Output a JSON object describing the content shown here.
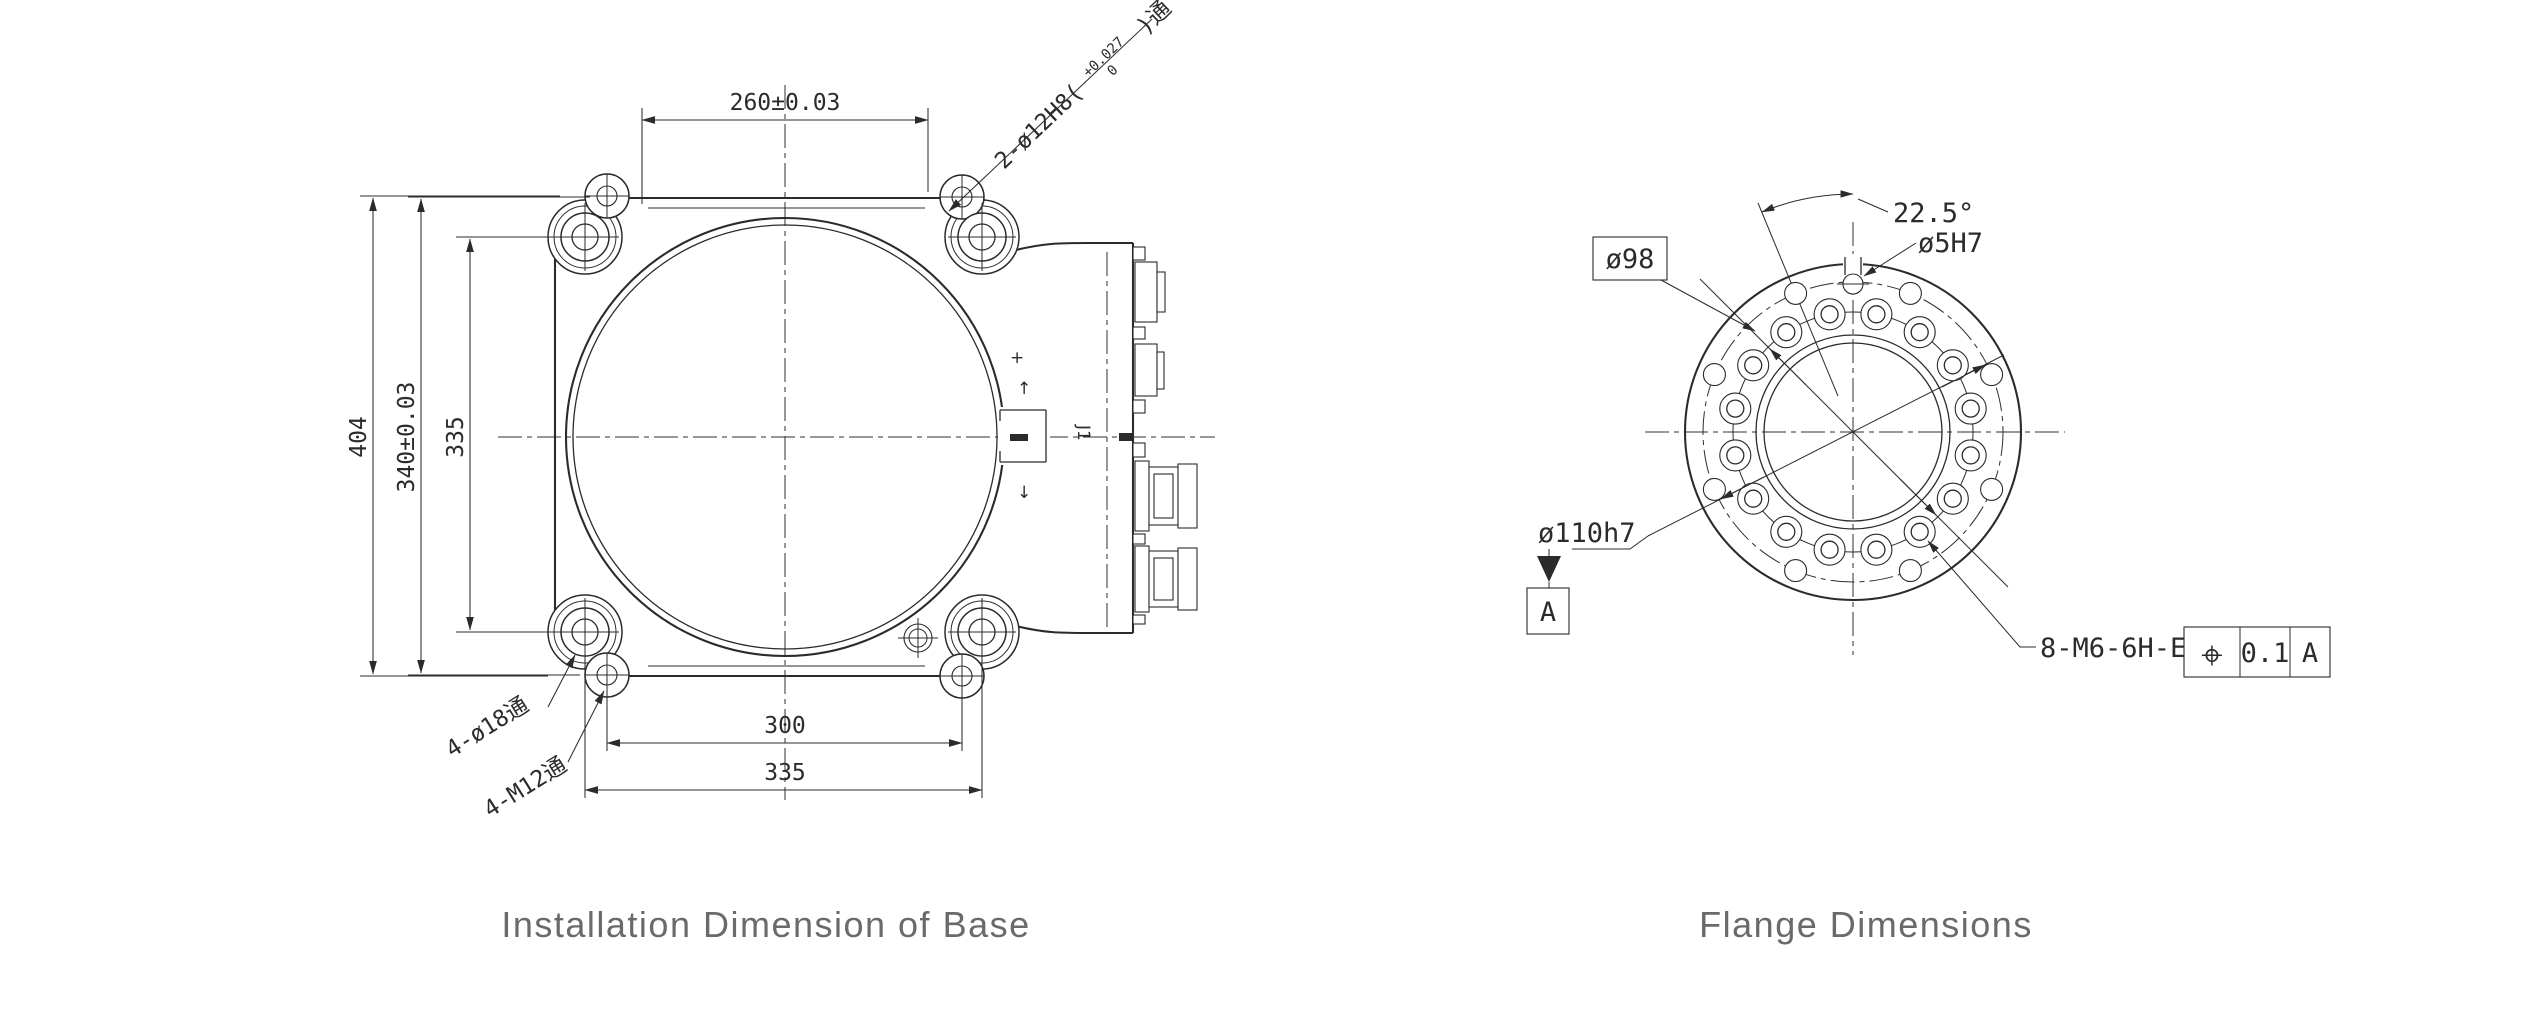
{
  "page": {
    "background": "#ffffff",
    "line_color": "#2b2b2b",
    "title_color": "#6a6a6a"
  },
  "base_view": {
    "title": "Installation Dimension of Base",
    "dims": {
      "pin_span_top": "260±0.03",
      "overall_height": "404",
      "pin_span_vertical": "340±0.03",
      "bolt_span_vertical": "335",
      "bolt_span_inner": "300",
      "bolt_span_outer": "335"
    },
    "labels": {
      "pin_holes_prefix": "2-ø12H8(",
      "pin_holes_tol_upper": "+0.027",
      "pin_holes_tol_lower": "0",
      "pin_holes_suffix": ")通",
      "through_holes": "4-ø18通",
      "threaded_holes": "4-M12通",
      "port": "J1",
      "marker_plus": "+",
      "marker_arrow_up": "↑",
      "marker_arrow_down": "↓"
    }
  },
  "flange_view": {
    "title": "Flange Dimensions",
    "labels": {
      "bolt_circle_dia": "ø98",
      "index_angle": "22.5°",
      "pin_hole_dia": "ø5H7",
      "spigot_dia": "ø110h7",
      "thread_spec": "8-M6-6H-EQS"
    },
    "datum_label": "A",
    "position_tolerance": {
      "symbol": "⌖",
      "value": "0.1",
      "datum": "A"
    }
  }
}
